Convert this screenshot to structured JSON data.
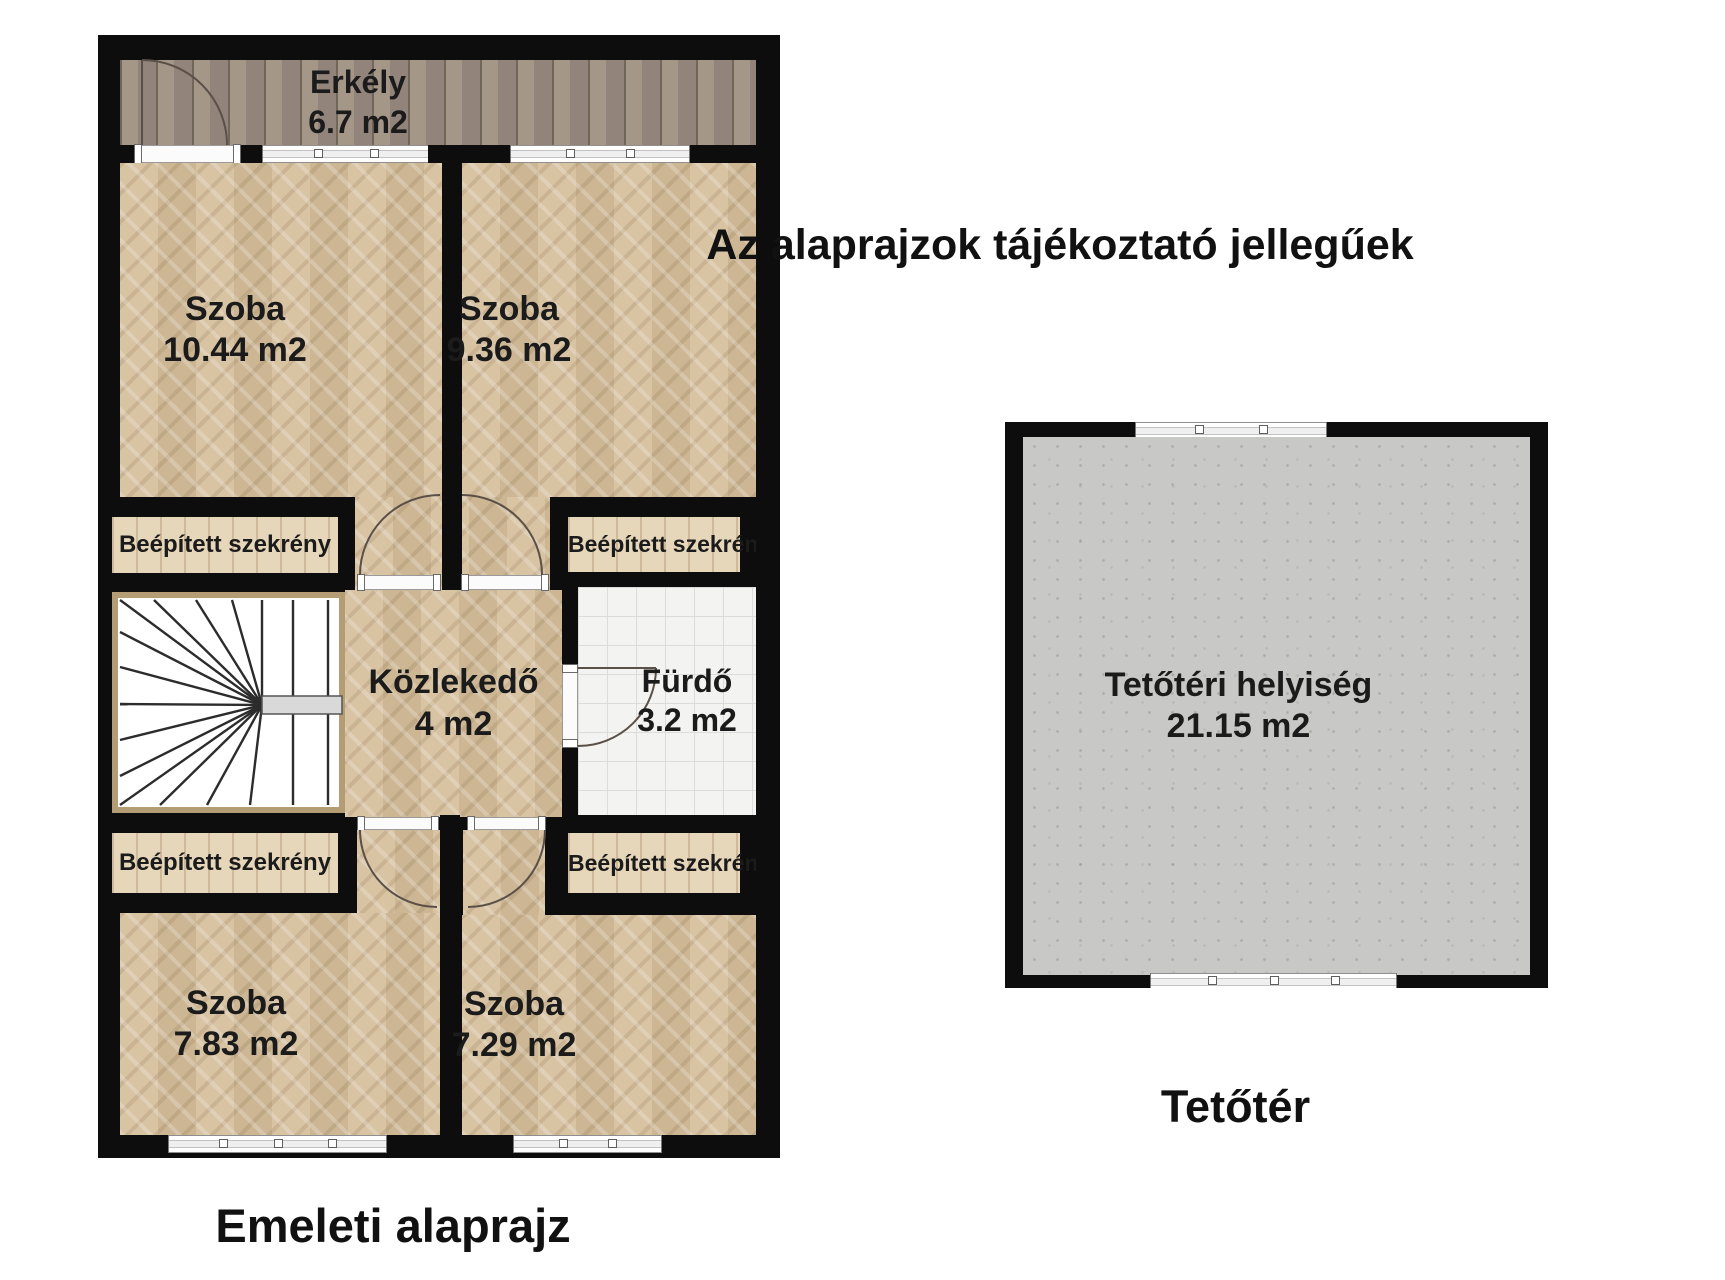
{
  "title": {
    "text": "Az alaprajzok tájékoztató jellegűek"
  },
  "upper_floor": {
    "caption": "Emeleti alaprajz",
    "balcony": {
      "name": "Erkély",
      "area": "6.7 m2"
    },
    "room_top_left": {
      "name": "Szoba",
      "area": "10.44 m2"
    },
    "room_top_right": {
      "name": "Szoba",
      "area": "9.36 m2"
    },
    "room_bottom_left": {
      "name": "Szoba",
      "area": "7.83 m2"
    },
    "room_bottom_right": {
      "name": "Szoba",
      "area": "7.29 m2"
    },
    "hallway": {
      "name": "Közlekedő",
      "area": "4 m2"
    },
    "bathroom": {
      "name": "Fürdő",
      "area": "3.2 m2"
    },
    "closet_label": "Beépített szekrény"
  },
  "attic_floor": {
    "caption": "Tetőtér",
    "room": {
      "name": "Tetőtéri helyiség",
      "area": "21.15 m2"
    }
  }
}
